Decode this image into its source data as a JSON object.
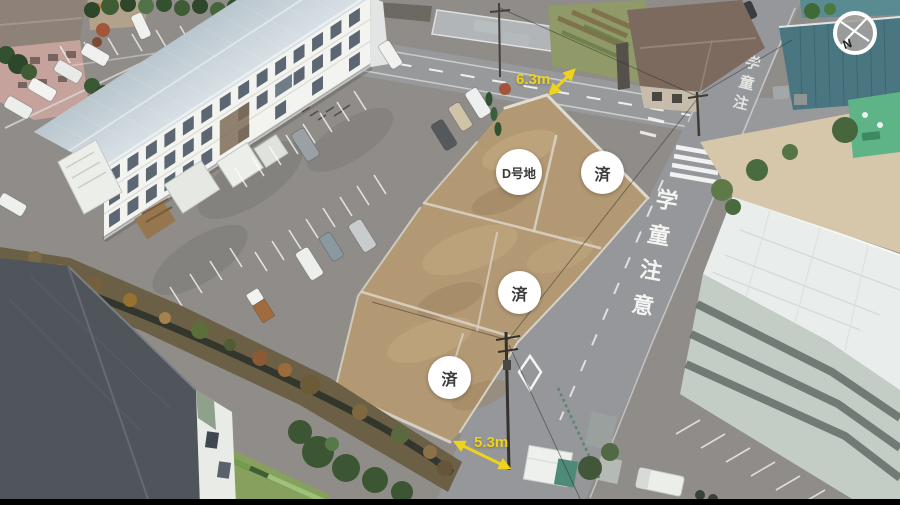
{
  "image_type": "aerial-drone-photo-of-land-plots",
  "plots": {
    "badges": [
      {
        "id": "plot-d",
        "label": "D号地"
      },
      {
        "id": "plot-sold-1",
        "label": "済"
      },
      {
        "id": "plot-sold-2",
        "label": "済"
      },
      {
        "id": "plot-sold-3",
        "label": "済"
      }
    ]
  },
  "measurements": {
    "front_road_width": "6.3m",
    "side_road_width": "5.3m"
  },
  "compass": {
    "north_label": "N"
  },
  "road_text": {
    "full": "学童注意",
    "chars": [
      "学",
      "童",
      "注",
      "意"
    ]
  },
  "colors": {
    "annotation_yellow": "#EFD31B",
    "badge_bg": "#FFFFFF",
    "badge_text": "#3B3B3B"
  }
}
